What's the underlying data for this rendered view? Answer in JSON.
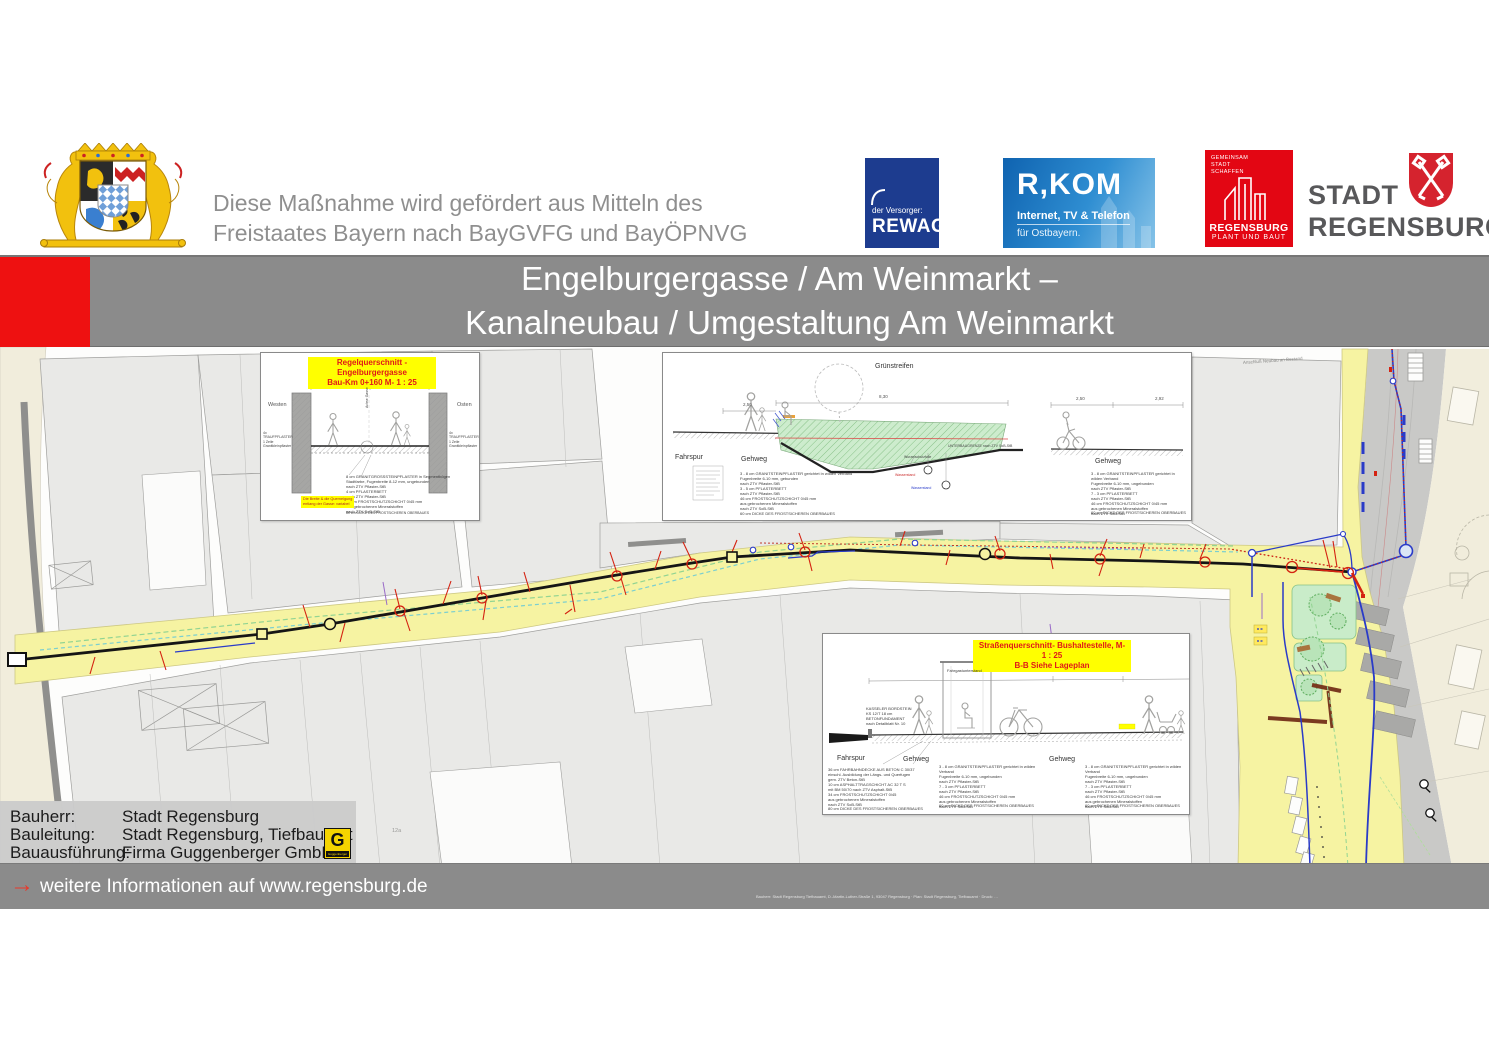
{
  "header": {
    "funding_text": "Diese Maßnahme wird gefördert aus Mitteln des\nFreistaates Bayern nach BayGVFG und BayÖPNVG",
    "logos": {
      "rewag": {
        "tagline": "der Versorger:",
        "name": "REWAG"
      },
      "rkom": {
        "name": "R,KOM",
        "sub1": "Internet, TV & Telefon",
        "sub2": "für Ostbayern."
      },
      "regensburg_plant": {
        "claim": "GEMEINSAM\nSTADT\nSCHAFFEN",
        "name1": "REGENSBURG",
        "name2": "PLANT UND BAUT"
      },
      "stadt_regensburg": {
        "name1": "STADT",
        "name2": "REGENSBURG"
      }
    }
  },
  "title_bar": {
    "line1": "Engelburgergasse / Am Weinmarkt –",
    "line2": "Kanalneubau / Umgestaltung Am Weinmarkt"
  },
  "sections": {
    "regelquerschnitt": {
      "title1": "Regelquerschnitt - Engelburgergasse",
      "title2": "Bau-Km 0+160    M- 1 : 25",
      "west": "Westen",
      "east": "Osten",
      "axis_label": "Achse Gasse",
      "west_note": "4x TRAUFPFLASTER\n1 Zeile Granitkleinpflaster",
      "east_note": "4x TRAUFPFLASTER\n1 Zeile Granitkleinpflaster",
      "buildup_note": "8 cm  GRANITGROSSSTEINPFLASTER in Segmentbögen\nStadtfarbe, Fugenbreite 8-12 mm, ungebunden\nnach ZTV Pflaster-StB\n4 cm  PFLASTERBETT\nnach ZTV Pflaster-StB\n47 cm  FROSTSCHUTZSCHICHT 0/45 mm\naus gebrochenen Mineralstoffen\nnach ZTV SoB-StB",
      "buildup_footer": "60 cm DICKE DES FROSTSICHEREN OBERBAUES",
      "variable_note": "Die Breite & die Querneigung\nentlang der Gasse: variabel"
    },
    "gruenstreifen": {
      "title": "Grünstreifen",
      "label_fahrspur": "Fahrspur",
      "label_gehweg_left": "Gehweg",
      "label_gehweg_right": "Gehweg",
      "label_wurzel": "Wurzelschutzfolie",
      "label_unterbau": "UNTERBAUGRENZE nach ZTV SoB-StB",
      "dim_total": "8,30",
      "dim_left": "2,50",
      "dim_right1": "2,50",
      "dim_right2": "2,92",
      "water_label_red": "Wasserstand",
      "water_label_blue": "Wasserstand",
      "left_note": "3 - 8 cm  GRANITSTEINPFLASTER gerichtet in wilden Verband\nFugenbreite 6-10 mm, gebunden\nnach ZTV Pflaster-StB\n3 - 5 cm  PFLASTERBETT\nnach ZTV Pflaster-StB\n46 cm  FROSTSCHUTZSCHICHT 0/45 mm\naus gebrochenen Mineralstoffen\nnach ZTV SoB-StB",
      "left_footer": "60 cm DICKE DES FROSTSICHEREN OBERBAUES",
      "right_note": "3 - 8 cm  GRANITSTEINPFLASTER gerichtet in wilden Verband\nFugenbreite 6-10 mm, ungebunden\nnach ZTV Pflaster-StB\n7 - 3 cm  PFLASTERBETT\nnach ZTV Pflaster-StB\n46 cm  FROSTSCHUTZSCHICHT 0/45 mm\naus gebrochenen Mineralstoffen\nnach ZTV SoB-StB",
      "right_footer": "60 cm DICKE DES FROSTSICHEREN OBERBAUES"
    },
    "bushaltestelle": {
      "title1": "Straßenquerschnitt- Bushaltestelle, M- 1 : 25",
      "title2": "B-B Siehe Lageplan",
      "shelter_label": "Fahrgastunterstand",
      "curb_note": "KASSELER BORDSTEIN\nKS 12/T 18 cm\nBETONFUNDAMENT\nnach Detailblatt Nr. 10",
      "label_fahrspur": "Fahrspur",
      "label_gehweg_left": "Gehweg",
      "label_gehweg_right": "Gehweg",
      "left_note": "36 cm  FAHRBAHNDECKE AUS BETON C 30/37\neinschl. Ausbildung der Längs- und Querfugen\ngem. ZTV Beton-StB\n10 cm  ASPHALTTRAGSCHICHT AC 32 T S\nmit BM 50/70 nach ZTV Asphalt-StB\n34 cm  FROSTSCHUTZSCHICHT 0/45\naus gebrochenen Mineralstoffen\nnach ZTV SoB-StB",
      "left_footer": "80 cm  DICKE DES FROSTSICHEREN OBERBAUES",
      "mid_note": "3 - 8 cm  GRANITSTEINPFLASTER gerichtet in wilden Verband\nFugenbreite 6-10 mm, ungebunden\nnach ZTV Pflaster-StB\n7 - 3 cm  PFLASTERBETT\nnach ZTV Pflaster-StB\n46 cm  FROSTSCHUTZSCHICHT 0/45 mm\naus gebrochenen Mineralstoffen\nnach ZTV SoB-StB",
      "mid_footer": "60 cm  DICKE DES FROSTSICHEREN OBERBAUES",
      "right_note": "3 - 8 cm  GRANITSTEINPFLASTER gerichtet in wilden Verband\nFugenbreite 6-10 mm, ungebunden\nnach ZTV Pflaster-StB\n7 - 3 cm  PFLASTERBETT\nnach ZTV Pflaster-StB\n46 cm  FROSTSCHUTZSCHICHT 0/45 mm\naus gebrochenen Mineralstoffen\nnach ZTV SoB-StB",
      "right_footer": "60 cm  DICKE DES FROSTSICHEREN OBERBAUES"
    }
  },
  "map": {
    "annotation_top_right": "Anschluß Neubau an Bestand",
    "parcel_number": "12a"
  },
  "info_box": {
    "rows": [
      {
        "label": "Bauherr:",
        "value": "Stadt Regensburg"
      },
      {
        "label": "Bauleitung:",
        "value": "Stadt Regensburg, Tiefbauamt"
      },
      {
        "label": "Bauausführung:",
        "value": "Firma Guggenberger GmbH"
      }
    ],
    "contractor_logo_letter": "G",
    "contractor_logo_name": "Guggenberger"
  },
  "footer": {
    "more_info": "weitere Informationen auf www.regensburg.de",
    "small_print": "Bauherr: Stadt Regensburg Tiefbauamt, D.-Martin-Luther-Straße 1, 93047 Regensburg · Plan: Stadt Regensburg, Tiefbauamt · Druck: …"
  },
  "colors": {
    "accent_red": "#ee1111",
    "bar_gray": "#8b8b8b",
    "street_yellow": "#f6f3a2",
    "highlight_yellow": "#ffff00",
    "canal_black": "#151515",
    "pipe_blue": "#2a3bc8",
    "connection_red": "#d42211"
  }
}
